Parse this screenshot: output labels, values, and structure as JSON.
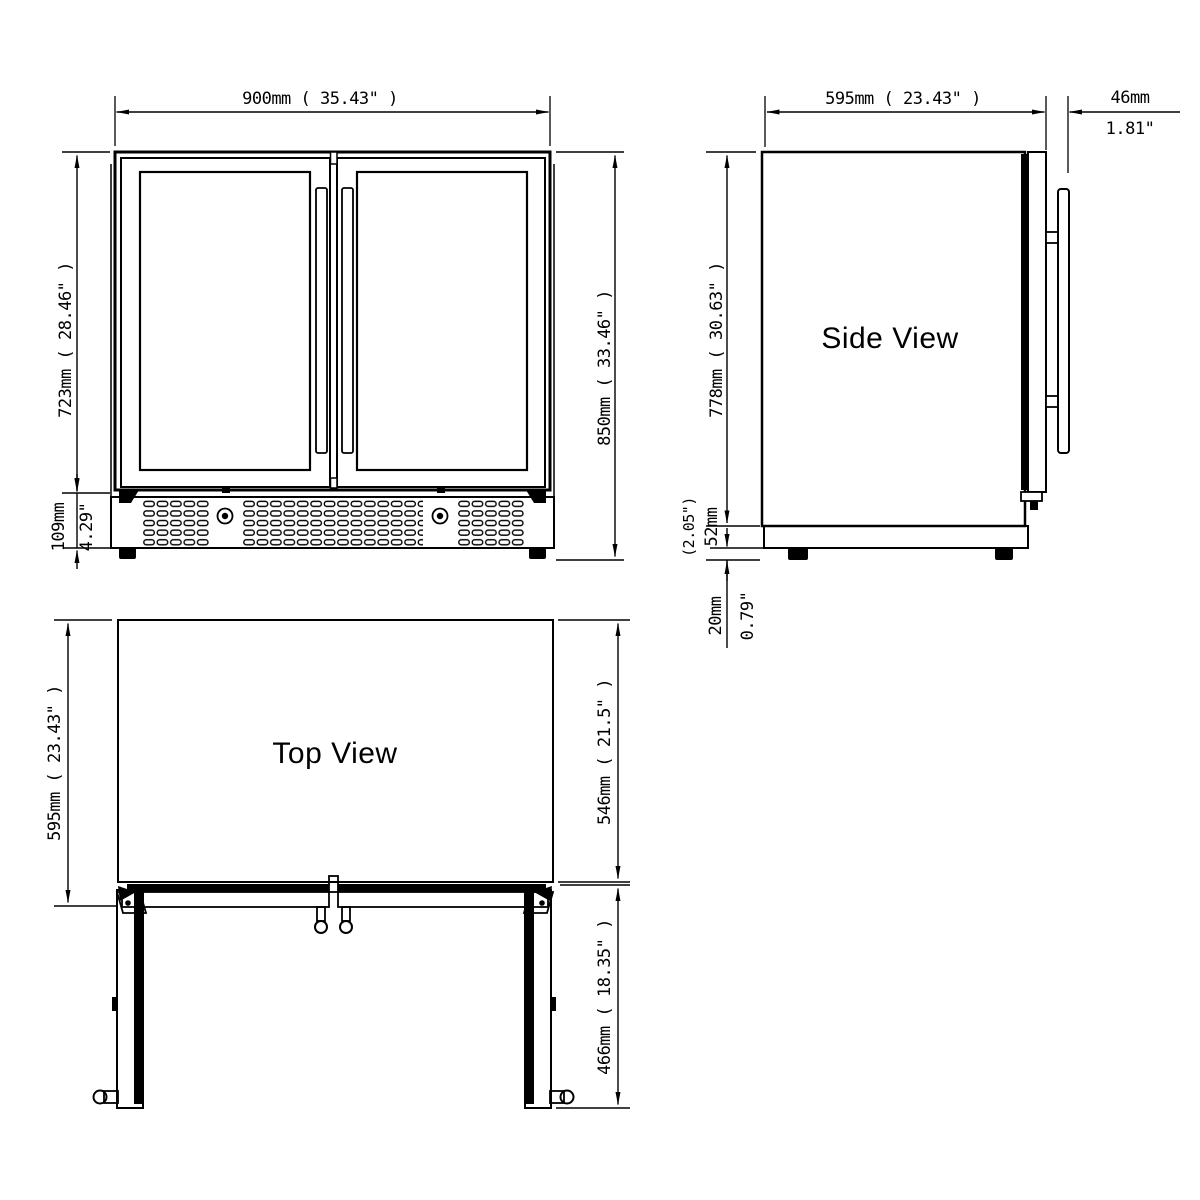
{
  "page": {
    "background_color": "#ffffff",
    "line_color": "#000000"
  },
  "front_view": {
    "width_label": "900mm ( 35.43\" )",
    "door_height_label": "723mm ( 28.46\" )",
    "vent_height_mm": "109mm",
    "vent_height_in": "4.29\"",
    "total_height_label": "850mm ( 33.46\" )"
  },
  "side_view": {
    "title": "Side View",
    "depth_label": "595mm ( 23.43\" )",
    "handle_depth_mm": "46mm",
    "handle_depth_in": "1.81\"",
    "body_height_label": "778mm ( 30.63\" )",
    "plinth_height_in": "(2.05\")",
    "plinth_height_mm": "52mm",
    "feet_height_mm": "20mm",
    "feet_height_in": "0.79\""
  },
  "top_view": {
    "title": "Top View",
    "depth_label": "595mm ( 23.43\" )",
    "body_depth_label": "546mm ( 21.5\" )",
    "door_swing_label": "466mm ( 18.35\" )"
  }
}
